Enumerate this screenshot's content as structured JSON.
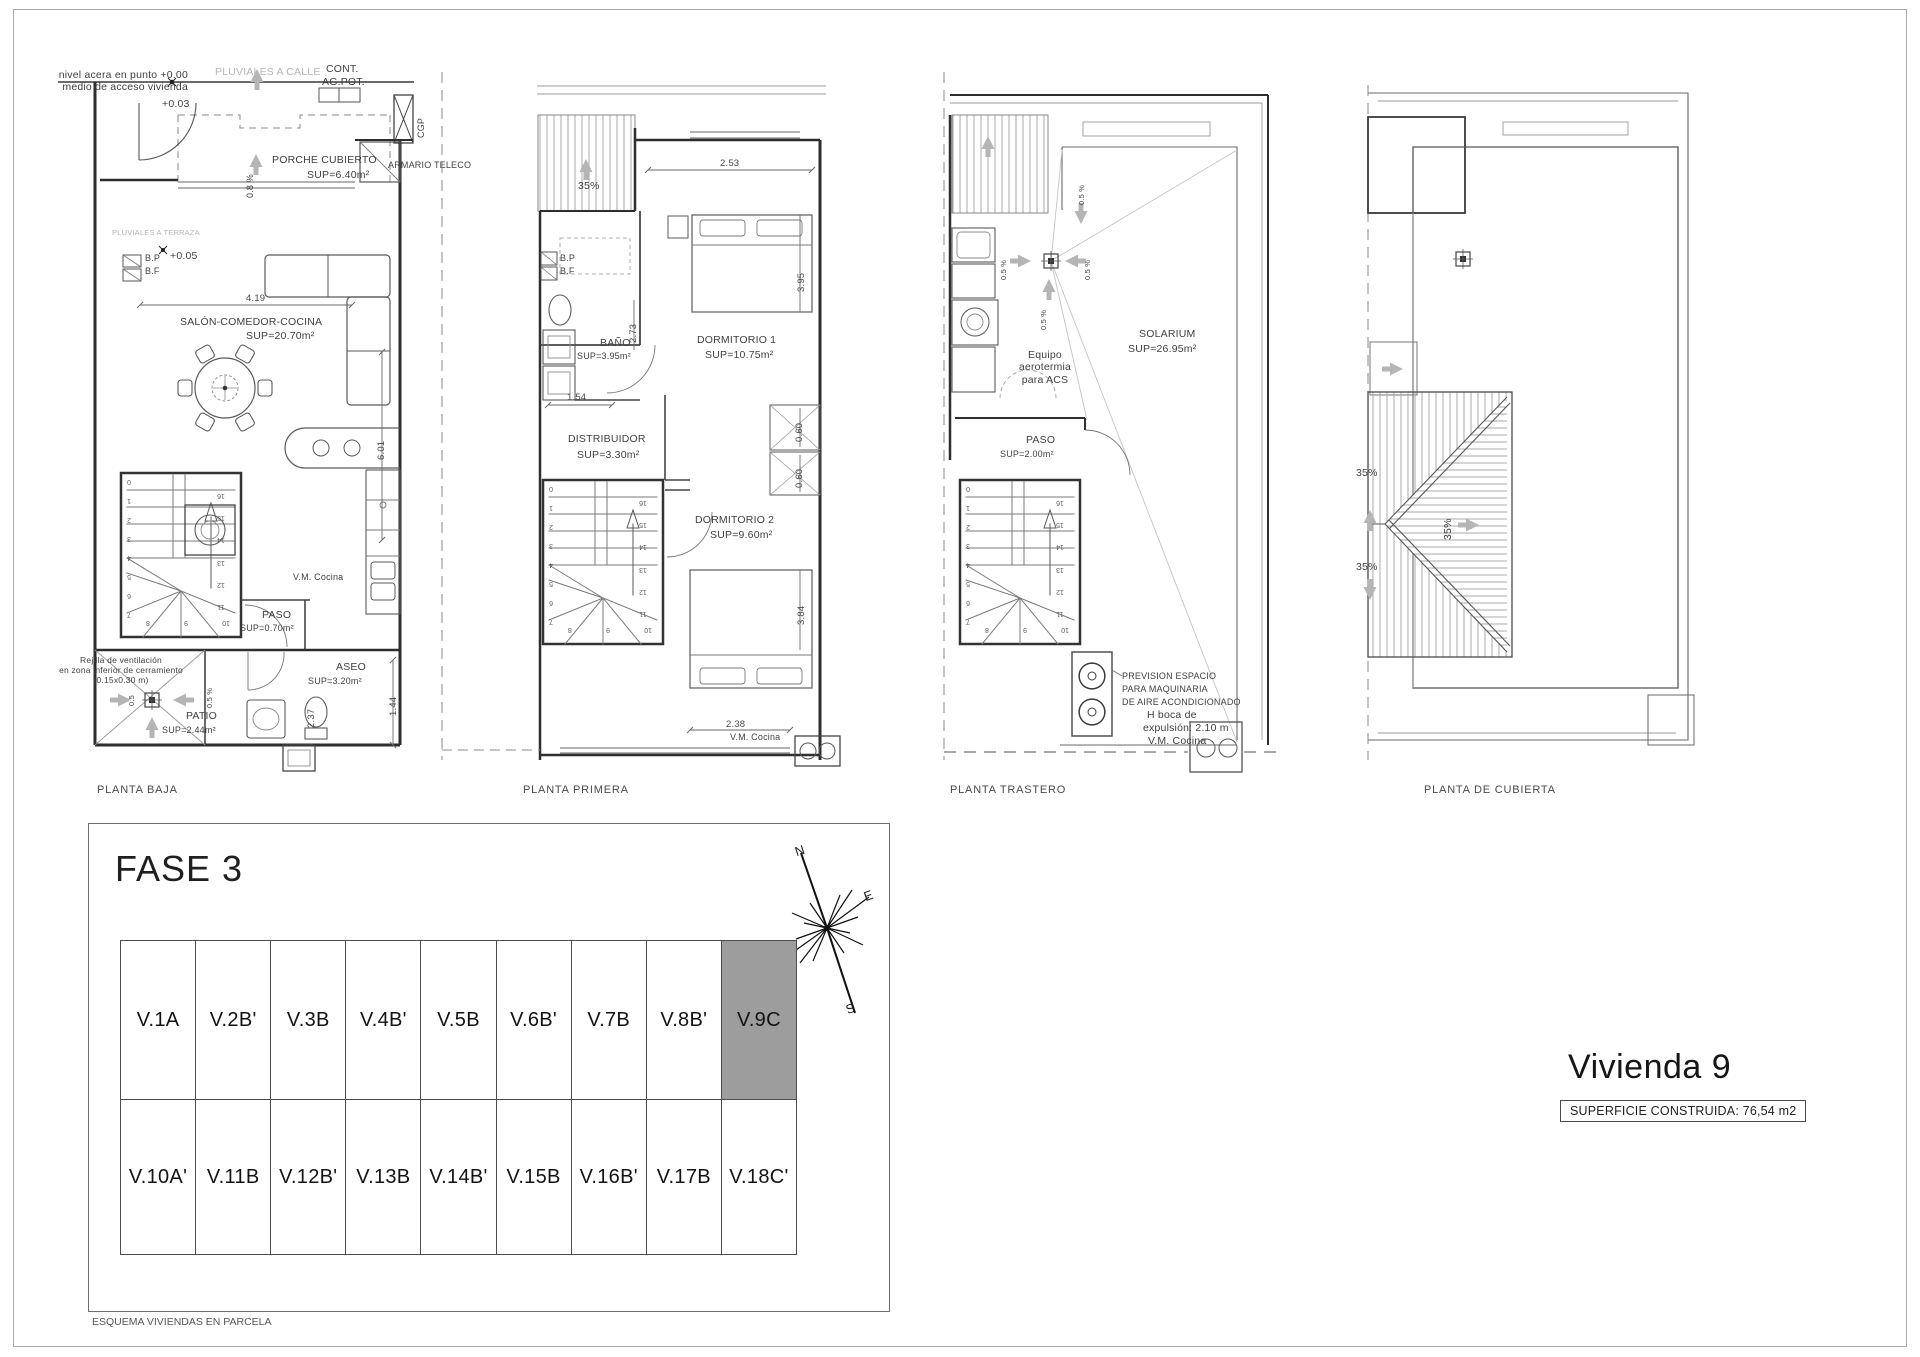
{
  "colors": {
    "highlight": "#9d9d9d",
    "line_dark": "#3a3a3a",
    "line_gray": "#b5b5b5"
  },
  "plans": {
    "baja": {
      "title": "PLANTA BAJA",
      "nivel_1": "nivel acera en punto +0.00",
      "nivel_2": "medio de acceso vivienda",
      "pluviales_calle": "PLUVIALES A CALLE",
      "cont": "CONT.",
      "agpot": "AG.POT.",
      "cota_003": "+0.03",
      "cgp": "CGP",
      "porche": "PORCHE CUBIERTO",
      "porche_sup": "SUP=6.40m²",
      "slope_08": "0.8 %",
      "armario": "ARMARIO TELECO",
      "pluviales_terraza": "PLUVIALES A TERRAZA",
      "bp": "B.P",
      "bf": "B.F",
      "cota_005": "+0.05",
      "dim_419": "4.19",
      "salon": "SALÓN-COMEDOR-COCINA",
      "salon_sup": "SUP=20.70m²",
      "dim_601": "6.01",
      "vm_cocina": "V.M. Cocina",
      "paso": "PASO",
      "paso_sup": "SUP=0.70m²",
      "rejilla_1": "Rejilla de ventilación",
      "rejilla_2": "en zona inferior de cerramiento",
      "rejilla_3": "(0.15x0.30 m)",
      "aseo": "ASEO",
      "aseo_sup": "SUP=3.20m²",
      "dim_144": "1.44",
      "slope_05a": "0.5",
      "slope_05b": "0.5 %",
      "patio": "PATIO",
      "patio_sup": "SUP=2.44m²",
      "dim_237": "2.37"
    },
    "primera": {
      "title": "PLANTA PRIMERA",
      "slope_35": "35%",
      "dim_253": "2.53",
      "dorm1": "DORMITORIO 1",
      "dorm1_sup": "SUP=10.75m²",
      "dim_395": "3.95",
      "bp": "B.P",
      "bf": "B.F",
      "bano": "BAÑO",
      "bano_sup": "SUP=3.95m²",
      "dim_273": "2.73",
      "dim_154": "1.54",
      "distribuidor": "DISTRIBUIDOR",
      "distribuidor_sup": "SUP=3.30m²",
      "dim_060a": "0.60",
      "dim_060b": "0.60",
      "dorm2": "DORMITORIO 2",
      "dorm2_sup": "SUP=9.60m²",
      "dim_384": "3.84",
      "dim_238": "2.38",
      "vm_cocina": "V.M. Cocina"
    },
    "trastero": {
      "title": "PLANTA TRASTERO",
      "slope_top": "0.5 %",
      "slope_left": "0.5 %",
      "slope_right": "0.5 %",
      "slope_bottom": "0.5 %",
      "solarium": "SOLARIUM",
      "solarium_sup": "SUP=26.95m²",
      "equipo_1": "Equipo",
      "equipo_2": "aerotermia",
      "equipo_3": "para ACS",
      "paso": "PASO",
      "paso_sup": "SUP=2.00m²",
      "prevision_1": "PREVISION ESPACIO",
      "prevision_2": "PARA MAQUINARIA",
      "prevision_3": "DE AIRE ACONDICIONADO",
      "boca_1": "H boca de",
      "boca_2": "expulsión: 2.10 m",
      "vm_cocina": "V.M. Cocina"
    },
    "cubierta": {
      "title": "PLANTA DE CUBIERTA",
      "slope_up": "35%",
      "slope_mid": "35%",
      "slope_down": "35%"
    },
    "stairs": {
      "left": [
        "7",
        "6",
        "5",
        "4",
        "3",
        "2",
        "1",
        "0"
      ],
      "bottom": [
        "10",
        "9",
        "8"
      ],
      "right": [
        "11",
        "12",
        "13",
        "14",
        "15",
        "16"
      ]
    }
  },
  "fase": {
    "title": "FASE 3",
    "caption": "ESQUEMA VIVIENDAS EN PARCELA",
    "row1": [
      "V.1A",
      "V.2B'",
      "V.3B",
      "V.4B'",
      "V.5B",
      "V.6B'",
      "V.7B",
      "V.8B'",
      "V.9C"
    ],
    "row2": [
      "V.10A'",
      "V.11B",
      "V.12B'",
      "V.13B",
      "V.14B'",
      "V.15B",
      "V.16B'",
      "V.17B",
      "V.18C'"
    ]
  },
  "compass": {
    "n": "N",
    "e": "E",
    "o": "O",
    "s": "S"
  },
  "titleblock": {
    "vivienda": "Vivienda 9",
    "superficie": "SUPERFICIE CONSTRUIDA: 76,54 m2"
  }
}
